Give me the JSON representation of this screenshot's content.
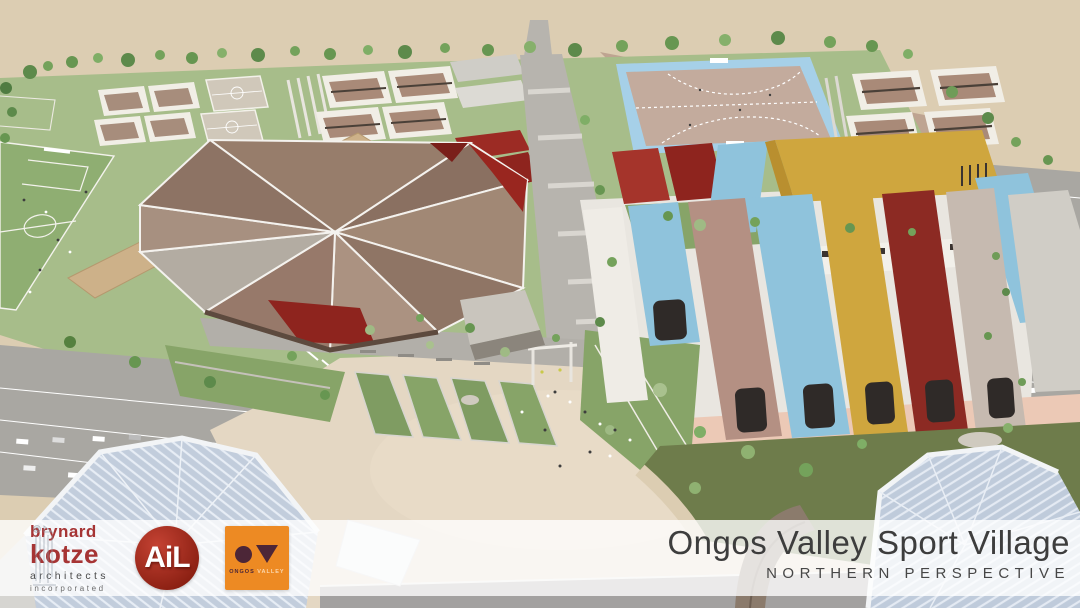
{
  "slide": {
    "title": "Ongos Valley Sport Village",
    "view": "NORTHERN PERSPECTIVE"
  },
  "logos": {
    "architect": {
      "line1": "brynard",
      "line2": "kotze",
      "line3": "architects",
      "line4": "incorporated"
    },
    "ail": {
      "text": "AiL"
    },
    "ongos": {
      "caption_primary": "ONGOS",
      "caption_secondary": "VALLEY"
    }
  },
  "palette": {
    "logoRed": "#a63434",
    "ailRedLight": "#c44233",
    "ailRedDark": "#8a1f12",
    "logoOrange": "#ed8a23",
    "logoMaroon": "#4c2637",
    "titleInk": "#3d3d3d",
    "sand": "#dccdb2",
    "plazaSand": "#e4d7c3",
    "grass": "#a7bd8a",
    "oliveGrass": "#6e7c4b",
    "arenaBrown": "#977d6b",
    "accentRed": "#99261f",
    "ribbonBlue": "#8fc3dc",
    "ribbonGold": "#cfa63e",
    "ribbonTan": "#b49083",
    "ribbonMaroon": "#8c2a23",
    "hockeyBlue": "#a6d0e8",
    "foregroundRoof": "#c2cddc"
  }
}
